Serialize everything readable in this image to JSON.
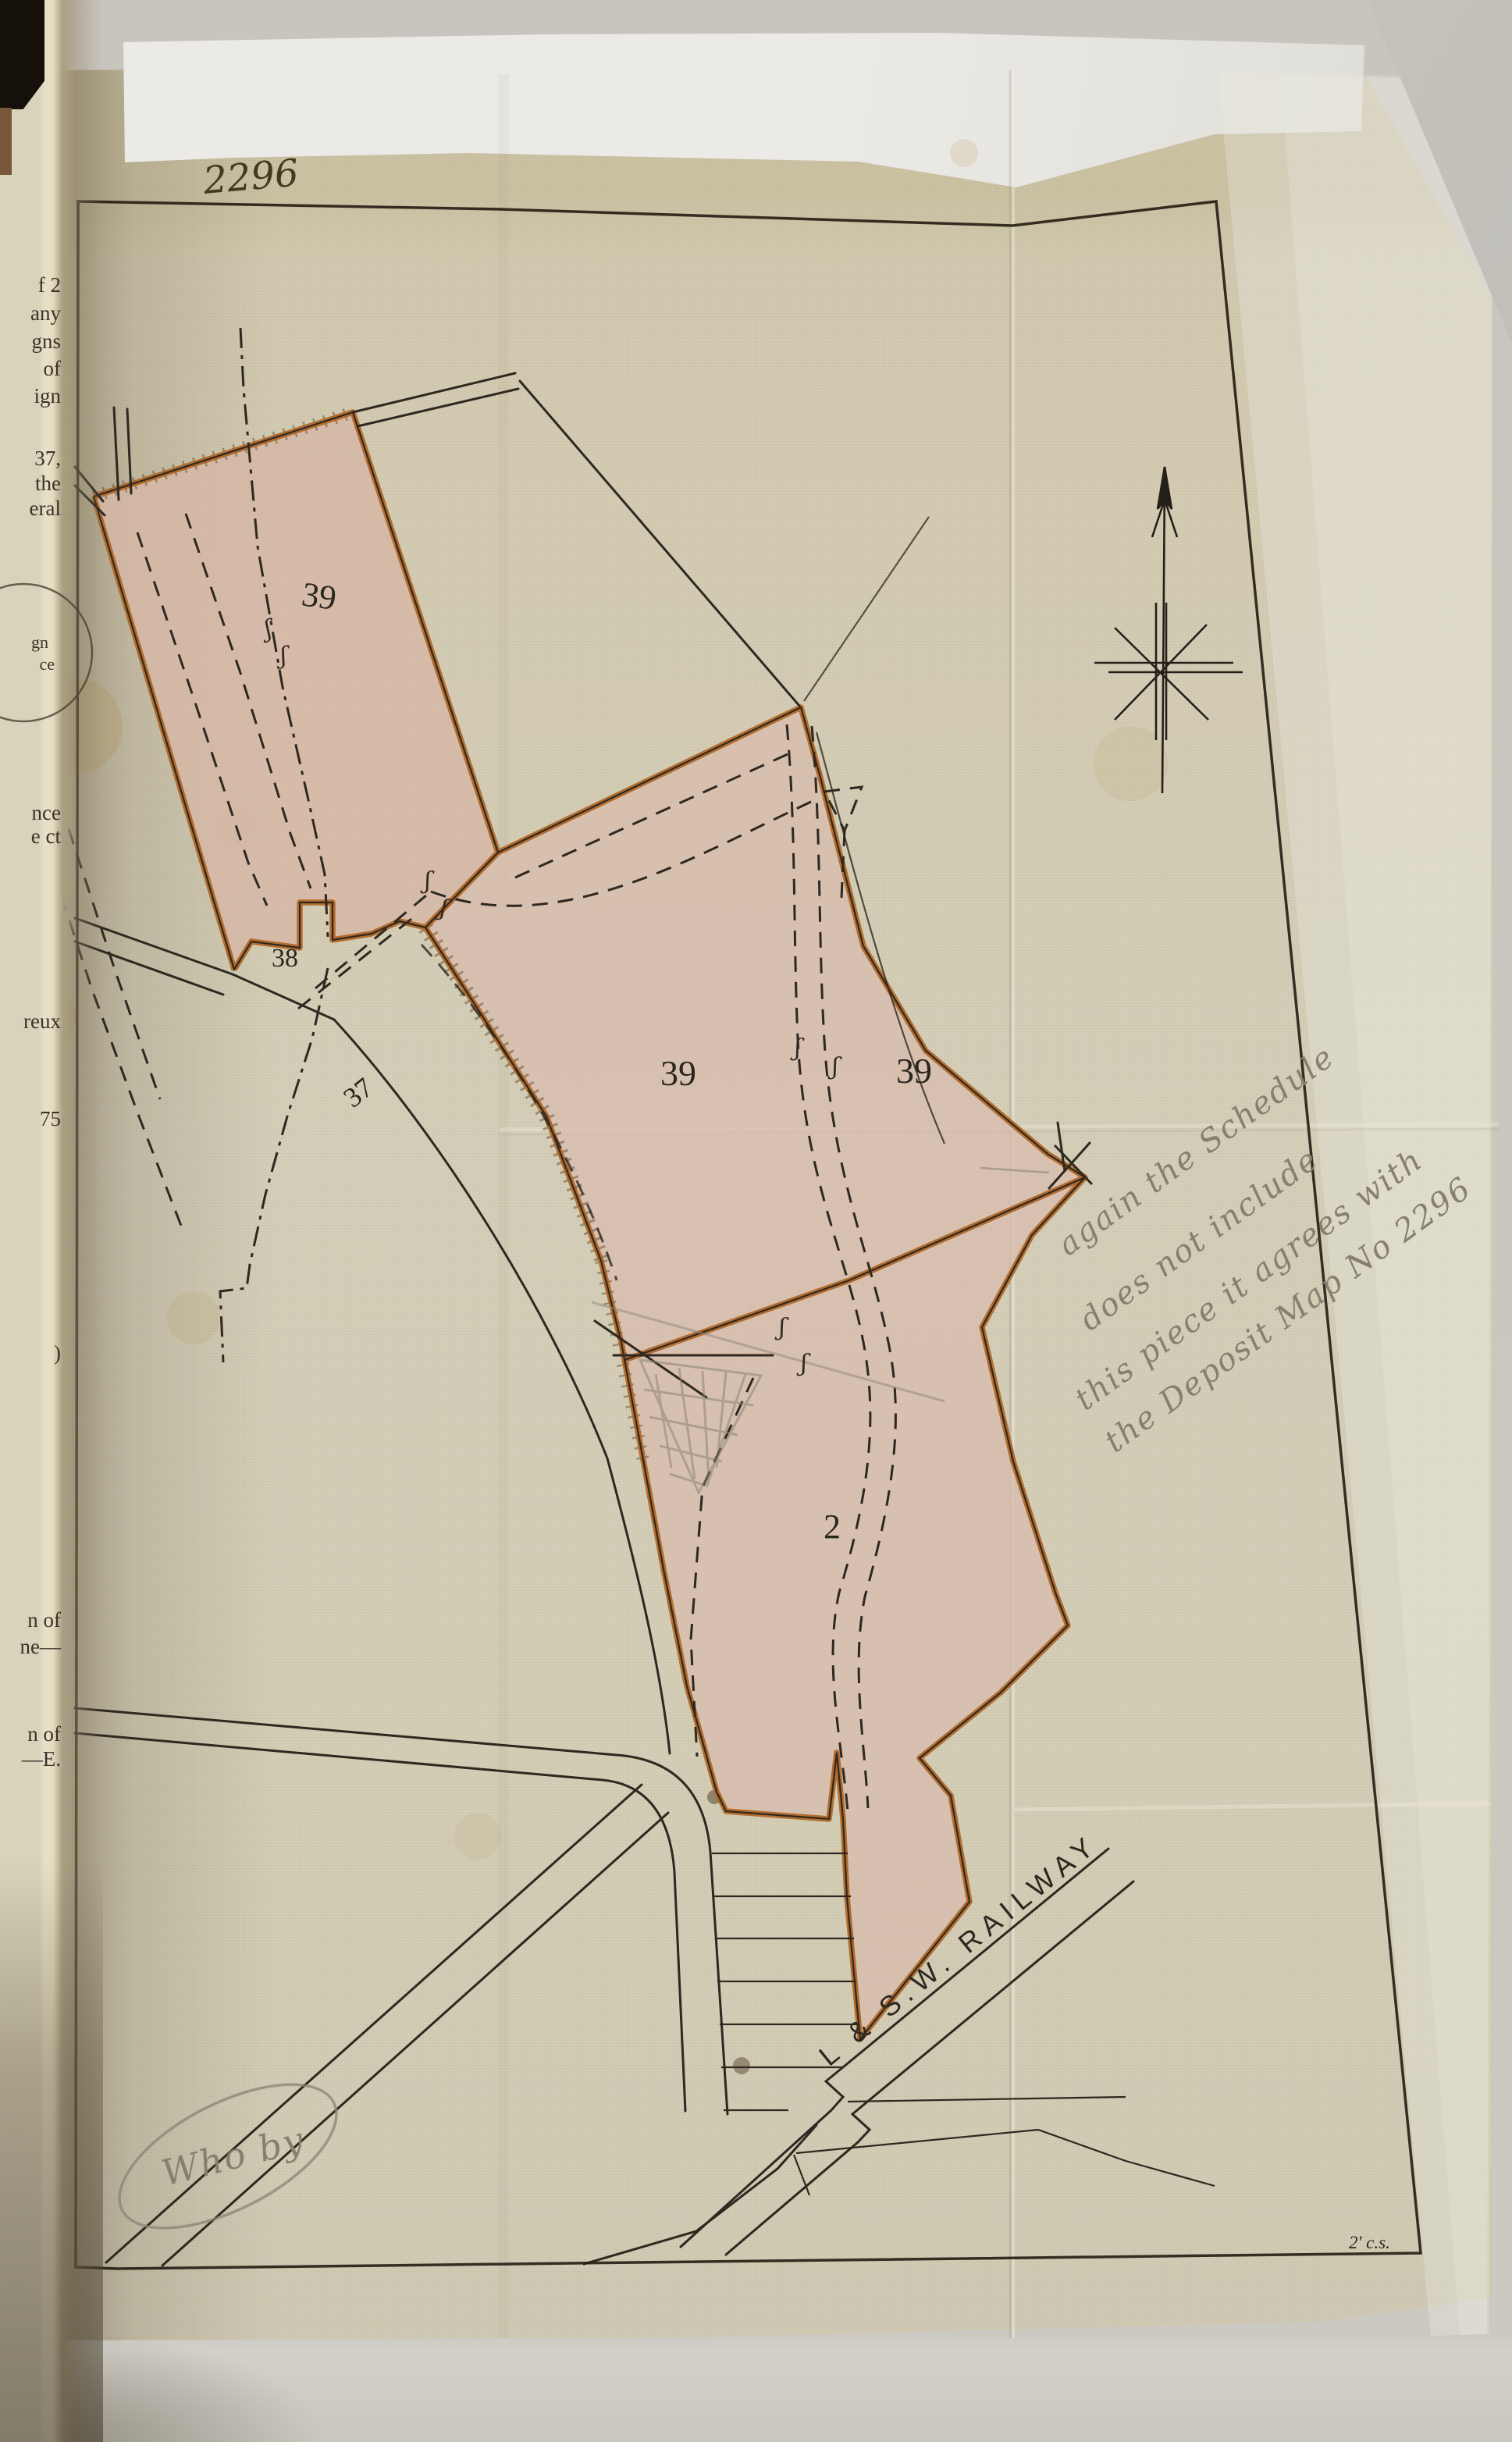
{
  "page": {
    "plan_number": "2296",
    "corner_mark": "2' c.s."
  },
  "book_page": {
    "fragments": [
      "f 2",
      "any",
      "gns",
      "of",
      "ign",
      "37,",
      "the",
      "eral",
      "nce",
      "e ct",
      "reux",
      "75",
      ")",
      "n of",
      "ne—",
      "n of",
      "—E."
    ],
    "stamp": {
      "line1": "gn",
      "line2": "ce"
    }
  },
  "map": {
    "parcel_labels": [
      "39",
      "38",
      "37",
      "39",
      "39",
      "2"
    ],
    "railway_label": "L & S.W. RAILWAY",
    "pencil_note_lines": [
      "again the Schedule",
      "does not include",
      "this piece it agrees with",
      "the Deposit Map No 2296"
    ],
    "oval_note": "Who by",
    "path_mark": "ʃ"
  },
  "colors": {
    "parcel_fill": "#d7bbaa",
    "boundary_orange": "#b06524",
    "ink": "#2e2820",
    "pencil": "#8b8375",
    "paper": "#d5cfb9"
  }
}
